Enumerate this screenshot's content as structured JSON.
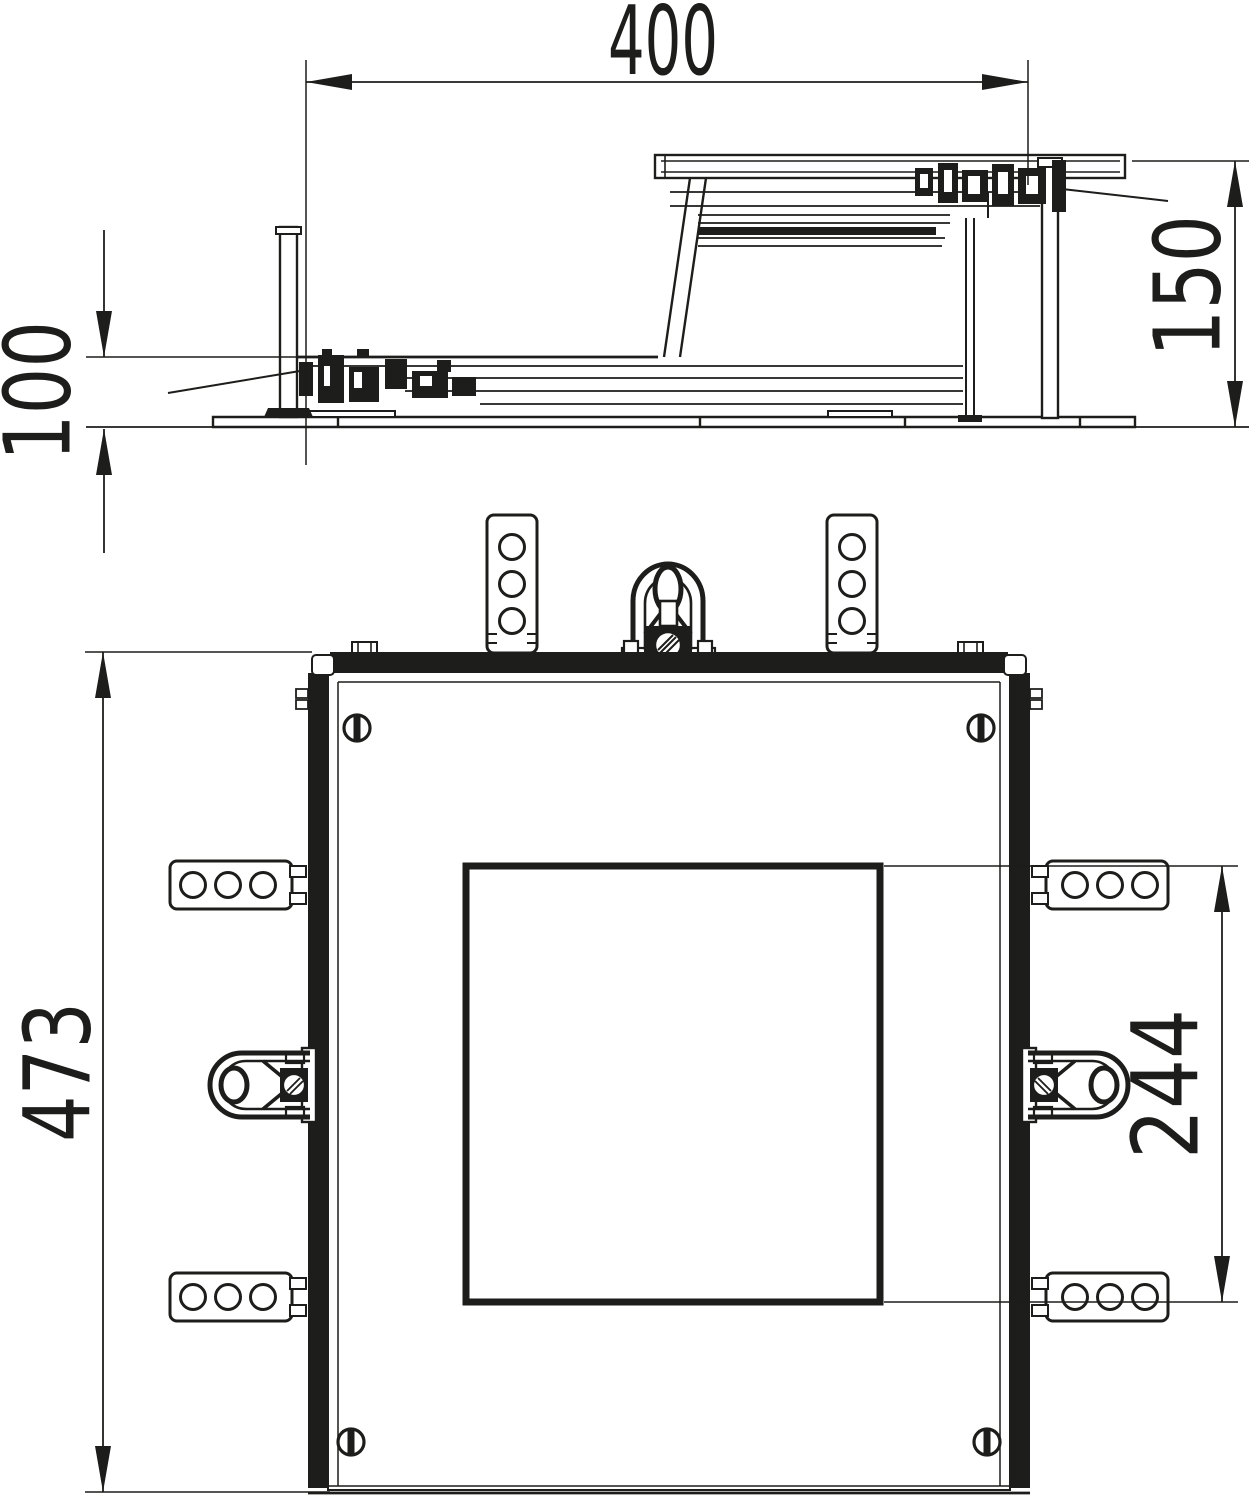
{
  "colors": {
    "line": "#1d1d1b",
    "background": "#ffffff",
    "fill": "#ffffff"
  },
  "side_view": {
    "width_dim": "400",
    "height_right_dim": "150",
    "height_left_dim": "100"
  },
  "plan_view": {
    "overall_dim": "473",
    "cutout_dim": "244"
  }
}
